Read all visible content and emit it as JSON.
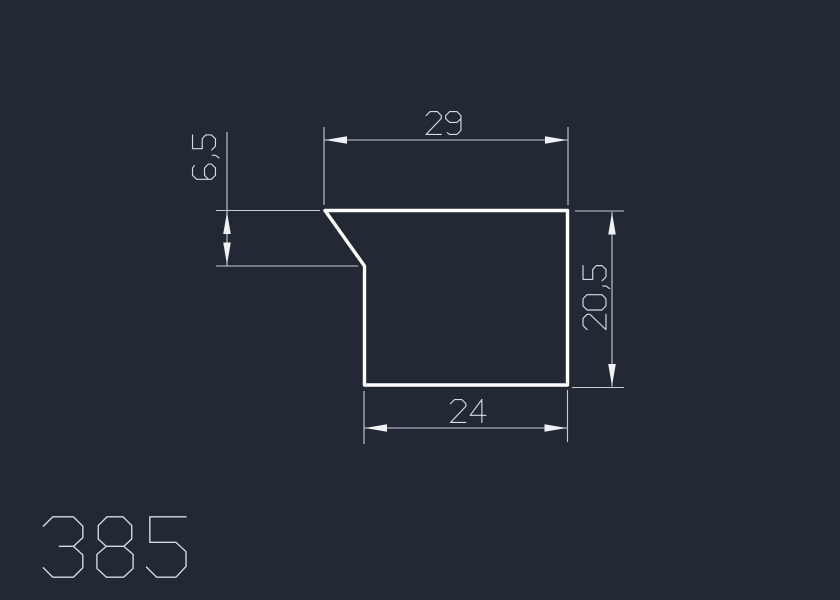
{
  "drawing": {
    "part_label": "385",
    "dimensions": {
      "top_width": {
        "label": "29",
        "value": 29
      },
      "left_height": {
        "label": "6,5",
        "value": 6.5
      },
      "right_height": {
        "label": "20,5",
        "value": 20.5
      },
      "bottom_width": {
        "label": "24",
        "value": 24
      }
    },
    "colors": {
      "background": "#222834",
      "profile_outline": "#ffffff",
      "dimension_lines": "#c8cdd5",
      "dimension_text": "#d7dbe1",
      "arrowheads": "#eff1f4"
    }
  }
}
